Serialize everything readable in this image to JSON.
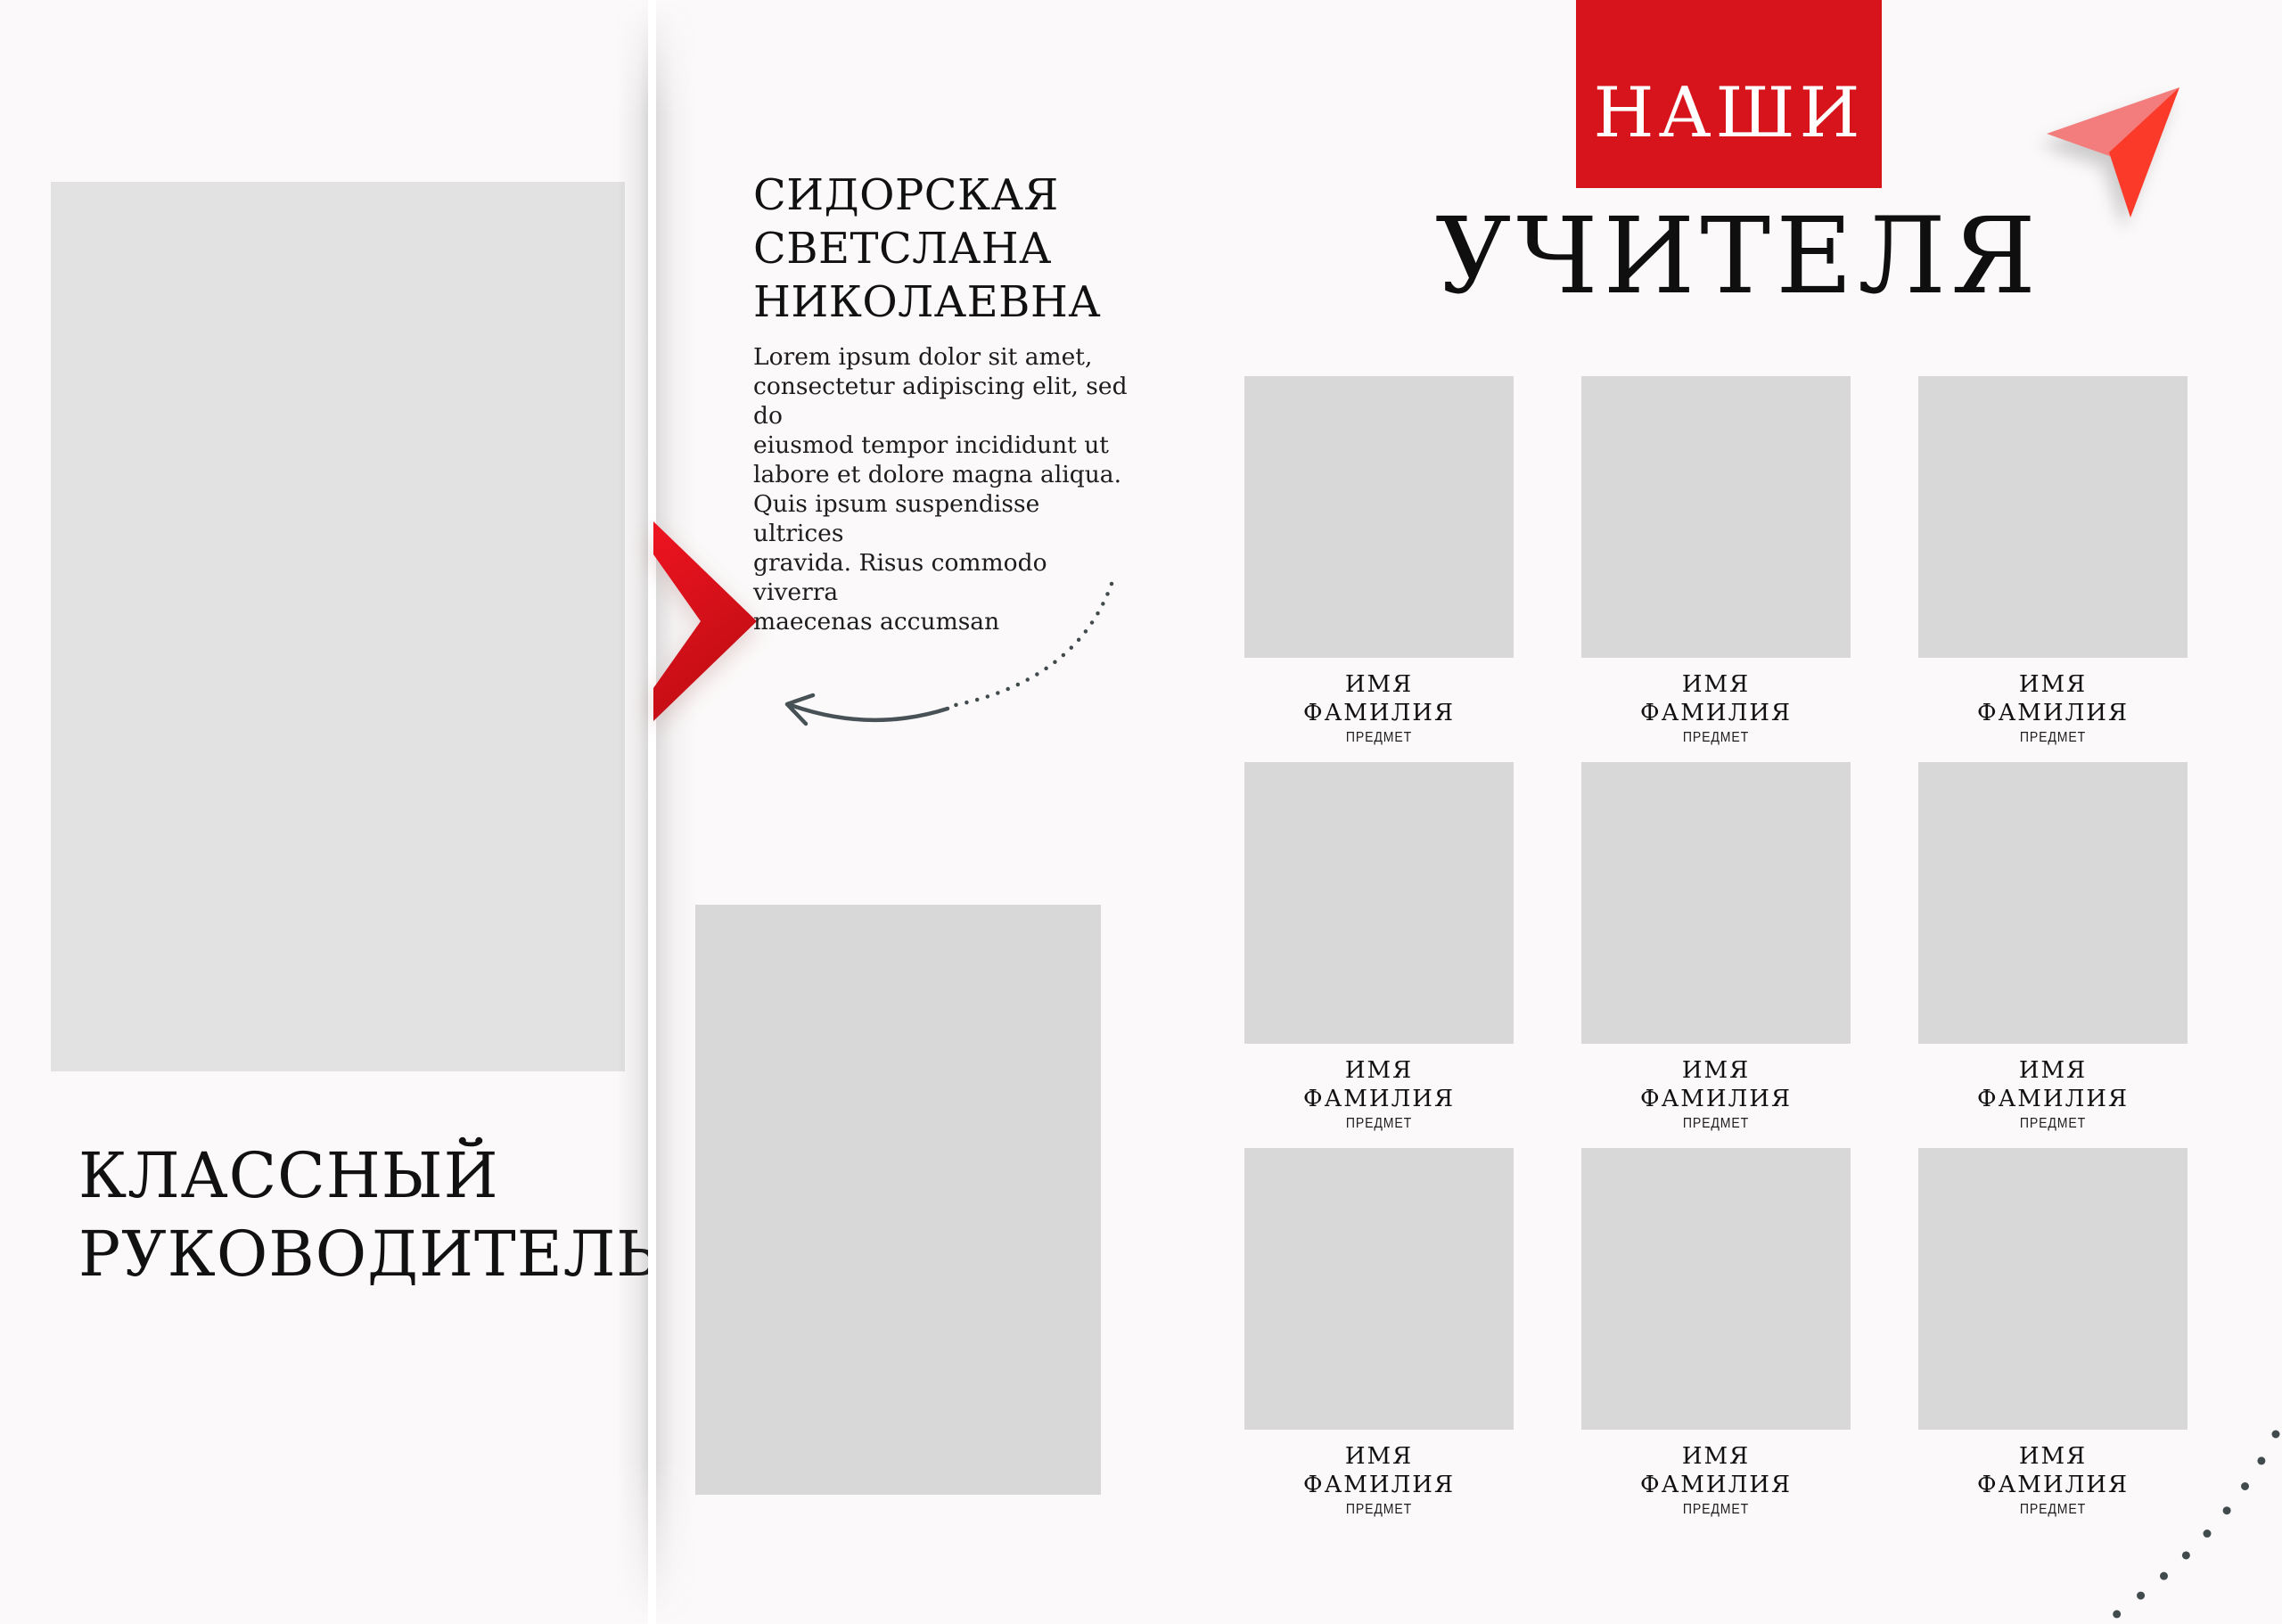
{
  "left_page": {
    "section_title": "КЛАССНЫЙ\nРУКОВОДИТЕЛЬ",
    "photo_placeholder": ""
  },
  "teacher_profile": {
    "full_name": "СИДОРСКАЯ\nСВЕТСЛАНА\nНИКОЛАЕВНА",
    "bio": "Lorem ipsum dolor sit amet,\nconsectetur adipiscing elit, sed do\neiusmod tempor incididunt ut\nlabore et dolore magna aliqua.\nQuis ipsum suspendisse ultrices\ngravida. Risus commodo viverra\nmaecenas accumsan"
  },
  "right_page": {
    "header_badge": "НАШИ",
    "header_title": "УЧИТЕЛЯ",
    "teachers": [
      {
        "first_name": "ИМЯ",
        "last_name": "ФАМИЛИЯ",
        "subject": "ПРЕДМЕТ"
      },
      {
        "first_name": "ИМЯ",
        "last_name": "ФАМИЛИЯ",
        "subject": "ПРЕДМЕТ"
      },
      {
        "first_name": "ИМЯ",
        "last_name": "ФАМИЛИЯ",
        "subject": "ПРЕДМЕТ"
      },
      {
        "first_name": "ИМЯ",
        "last_name": "ФАМИЛИЯ",
        "subject": "ПРЕДМЕТ"
      },
      {
        "first_name": "ИМЯ",
        "last_name": "ФАМИЛИЯ",
        "subject": "ПРЕДМЕТ"
      },
      {
        "first_name": "ИМЯ",
        "last_name": "ФАМИЛИЯ",
        "subject": "ПРЕДМЕТ"
      },
      {
        "first_name": "ИМЯ",
        "last_name": "ФАМИЛИЯ",
        "subject": "ПРЕДМЕТ"
      },
      {
        "first_name": "ИМЯ",
        "last_name": "ФАМИЛИЯ",
        "subject": "ПРЕДМЕТ"
      },
      {
        "first_name": "ИМЯ",
        "last_name": "ФАМИЛИЯ",
        "subject": "ПРЕДМЕТ"
      }
    ]
  },
  "colors": {
    "background": "#fbf9f9",
    "accent_red": "#d7131b",
    "chevron_red_top": "#ee1420",
    "chevron_red_bottom": "#c10d14",
    "plane_pink": "#f37c7c",
    "plane_red": "#fb3a2a",
    "photo_placeholder": "#e3e2e2",
    "grid_placeholder": "#d8d8d8",
    "arrow": "#475156",
    "dots": "#414b4e",
    "text": "#111111"
  }
}
